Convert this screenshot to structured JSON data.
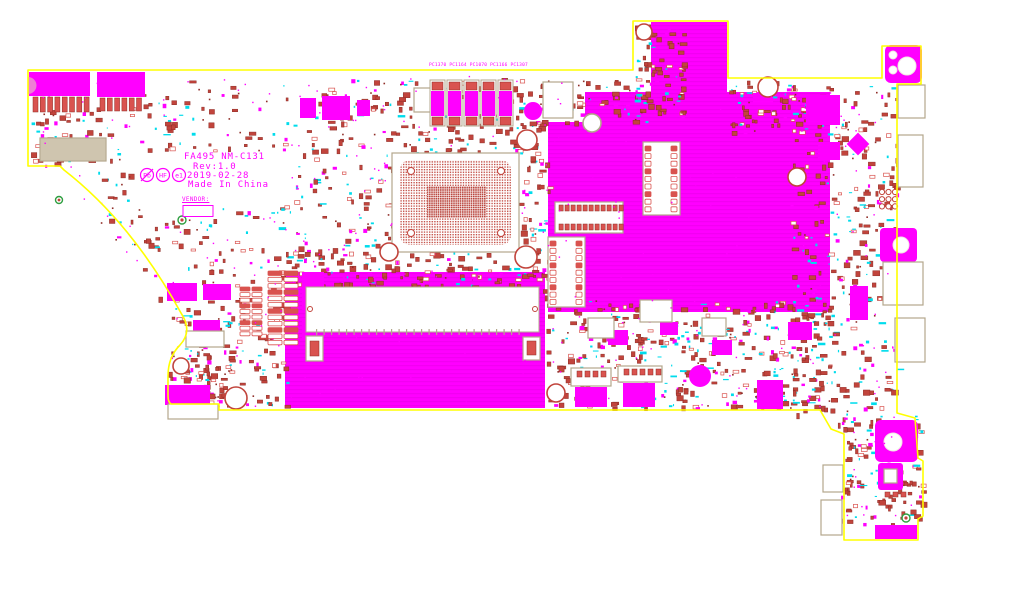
{
  "app": {
    "background": "#ffffff",
    "view": "boardview-top-layer"
  },
  "palette": {
    "bg": "#ffffff",
    "outline": "#ffff00",
    "copper": "#ff00ff",
    "copper_hatch": "#e200e2",
    "part": "#c1443c",
    "part_dark": "#8f2d27",
    "part_light": "#d97c74",
    "cyan": "#00dcec",
    "tan": "#cfc5af",
    "tan_dark": "#b3a78c",
    "silk_text": "#ff00ff",
    "pad_red": "#d9534f",
    "green": "#2e9e40",
    "notch_pink": "#ee7fd4"
  },
  "board": {
    "title_block": {
      "model": "FA495 NM-C131",
      "rev": "Rev:1.0",
      "date": "2019-02-28",
      "origin": "Made In China",
      "vendor_label": "VENDOR:"
    },
    "compliance_marks": [
      {
        "label": "Pb",
        "slash": true
      },
      {
        "label": "HF",
        "slash": false
      },
      {
        "label": "e1",
        "slash": false
      }
    ],
    "cap_labels": "PC1370 PC1164 PC1070 PC1166 PC1307",
    "outline_path": "M28,70 L633,70 L633,21 L728,21 L728,78 L882,78 L882,46 L921,46 L921,84 L897,84 L897,413 L915,418 L918,458 L923,461 L923,516 L918,519 L918,540 L844,540 L844,434 L831,429 L820,410 L219,410 L219,404 L171,404 Q168,402 168,396 L168,376 Q168,357 180,345 Q193,331 181,313 Q131,222 64,170 L60,166 L28,166 Z",
    "notch_path": "M28,77 A8.5,8.5 0 0 1 28,94 Z",
    "copper_regions": [
      "M548,122 L585,122 L585,92 L651,92 L651,22 L727,22 L727,92 L830,92 L830,312 L548,312 Z",
      "M285,272 L545,272 L545,408 L285,408 Z"
    ],
    "copper_blocks": [
      [
        29,
        72,
        61,
        24
      ],
      [
        97,
        72,
        48,
        25
      ],
      [
        300,
        98,
        16,
        20
      ],
      [
        322,
        96,
        28,
        24
      ],
      [
        357,
        100,
        13,
        16
      ],
      [
        549,
        87,
        17,
        26
      ],
      [
        753,
        93,
        20,
        12
      ],
      [
        167,
        283,
        30,
        18
      ],
      [
        203,
        284,
        28,
        16
      ],
      [
        302,
        272,
        22,
        38
      ],
      [
        302,
        318,
        16,
        22
      ],
      [
        193,
        320,
        27,
        15
      ],
      [
        165,
        385,
        45,
        20
      ],
      [
        192,
        334,
        26,
        11
      ],
      [
        575,
        387,
        32,
        20
      ],
      [
        623,
        383,
        32,
        24
      ],
      [
        757,
        380,
        26,
        29
      ],
      [
        608,
        330,
        20,
        15
      ],
      [
        660,
        322,
        18,
        13
      ],
      [
        712,
        340,
        20,
        15
      ],
      [
        788,
        322,
        24,
        18
      ],
      [
        806,
        95,
        34,
        30
      ],
      [
        818,
        142,
        22,
        18
      ],
      [
        850,
        286,
        18,
        34
      ],
      [
        880,
        228,
        37,
        34,
        4
      ],
      [
        885,
        45,
        37,
        38,
        6
      ],
      [
        875,
        420,
        43,
        42,
        6
      ],
      [
        878,
        463,
        25,
        27,
        3
      ],
      [
        875,
        525,
        42,
        14
      ]
    ],
    "diamonds": [
      [
        858,
        144,
        16
      ]
    ],
    "boxes": [
      [
        555,
        202,
        68,
        31
      ],
      [
        643,
        142,
        37,
        73
      ],
      [
        548,
        237,
        37,
        70
      ],
      [
        414,
        88,
        26,
        24
      ],
      [
        543,
        82,
        30,
        36
      ],
      [
        186,
        331,
        38,
        16
      ],
      [
        168,
        404,
        50,
        15
      ],
      [
        571,
        368,
        40,
        18
      ],
      [
        618,
        366,
        44,
        16
      ],
      [
        898,
        85,
        27,
        33
      ],
      [
        898,
        135,
        25,
        52
      ],
      [
        883,
        262,
        40,
        43
      ],
      [
        895,
        318,
        30,
        44
      ],
      [
        823,
        465,
        20,
        27
      ],
      [
        821,
        500,
        21,
        35
      ],
      [
        306,
        336,
        17,
        25
      ],
      [
        523,
        337,
        17,
        23
      ],
      [
        588,
        318,
        26,
        20
      ],
      [
        640,
        300,
        32,
        22
      ],
      [
        702,
        318,
        24,
        18
      ],
      [
        884,
        469,
        13,
        14
      ],
      [
        40,
        138,
        66,
        23
      ]
    ],
    "pad_rows": [
      [
        33,
        97,
        8,
        7.3,
        5,
        15
      ],
      [
        100,
        98,
        6,
        7.3,
        5,
        13
      ],
      [
        559,
        205,
        11,
        6,
        4.2,
        6
      ],
      [
        559,
        224,
        11,
        6,
        4.2,
        6
      ],
      [
        314,
        291,
        36,
        6,
        4.2,
        9
      ],
      [
        314,
        317,
        36,
        6,
        4.2,
        9
      ],
      [
        577,
        371,
        4,
        8,
        5,
        6
      ],
      [
        624,
        369,
        5,
        8,
        5,
        6
      ],
      [
        310,
        341,
        1,
        0,
        9,
        15
      ],
      [
        527,
        341,
        1,
        0,
        9,
        14
      ],
      [
        885,
        492,
        3,
        8,
        5,
        5
      ]
    ],
    "ladders": [
      [
        645,
        146,
        9,
        7.6,
        6,
        5
      ],
      [
        671,
        146,
        9,
        7.6,
        6,
        5
      ],
      [
        550,
        241,
        9,
        7.3,
        6,
        5
      ],
      [
        576,
        241,
        9,
        7.3,
        6,
        5
      ],
      [
        268,
        271,
        12,
        6.3,
        14,
        4.5
      ],
      [
        284,
        271,
        12,
        6.3,
        14,
        4.5
      ],
      [
        240,
        287,
        9,
        5.6,
        10,
        4
      ],
      [
        252,
        287,
        9,
        5.6,
        10,
        4
      ]
    ],
    "caps_row": {
      "x0": 430,
      "dx": 17,
      "n": 5,
      "y": 80
    },
    "bga": {
      "x": 392,
      "y": 153,
      "w": 127,
      "h": 99,
      "pad": 8,
      "dense": [
        427,
        186,
        59,
        32
      ],
      "corners": [
        [
          411,
          171
        ],
        [
          501,
          171
        ],
        [
          411,
          233
        ],
        [
          501,
          233
        ]
      ]
    },
    "ram": {
      "x": 306,
      "y": 287,
      "w": 233,
      "h": 45,
      "ticks": 28
    },
    "circles": [
      [
        644,
        32,
        8,
        "ring"
      ],
      [
        768,
        87,
        10,
        "ring"
      ],
      [
        592,
        123,
        9,
        "ringTan"
      ],
      [
        797,
        177,
        9,
        "ring"
      ],
      [
        527,
        140,
        10,
        "ring"
      ],
      [
        533,
        111,
        9,
        "fillM"
      ],
      [
        389,
        252,
        9,
        "ring"
      ],
      [
        526,
        257,
        11,
        "ring"
      ],
      [
        236,
        398,
        11,
        "ring"
      ],
      [
        556,
        393,
        9,
        "ring"
      ],
      [
        700,
        376,
        11,
        "fillM"
      ],
      [
        181,
        366,
        8,
        "ring"
      ],
      [
        59,
        200,
        3.5,
        "green"
      ],
      [
        182,
        220,
        4,
        "green"
      ],
      [
        906,
        518,
        4,
        "green"
      ],
      [
        901,
        245,
        8,
        "white"
      ],
      [
        907,
        66,
        9,
        "white"
      ],
      [
        893,
        55,
        4,
        "white"
      ],
      [
        893,
        70,
        4,
        "white"
      ],
      [
        893,
        442,
        9,
        "white"
      ],
      [
        310,
        309,
        2.5,
        "ringS"
      ],
      [
        535,
        309,
        2.5,
        "ringS"
      ]
    ],
    "ring_cluster": {
      "x": 882,
      "y": 192,
      "cols": 3,
      "rows": 3,
      "dx": 6.5,
      "dy": 7.2,
      "r": 2.6
    },
    "scatter_regions": [
      [
        95,
        78,
        300,
        225,
        420
      ],
      [
        30,
        110,
        62,
        55,
        45
      ],
      [
        165,
        300,
        122,
        108,
        150
      ],
      [
        285,
        252,
        262,
        36,
        110
      ],
      [
        395,
        75,
        152,
        88,
        130
      ],
      [
        515,
        90,
        33,
        222,
        90
      ],
      [
        545,
        300,
        290,
        108,
        430
      ],
      [
        790,
        85,
        108,
        330,
        310
      ],
      [
        635,
        20,
        48,
        96,
        90
      ],
      [
        728,
        80,
        78,
        52,
        70
      ],
      [
        838,
        415,
        84,
        112,
        130
      ],
      [
        160,
        345,
        70,
        60,
        55
      ],
      [
        540,
        80,
        110,
        42,
        60
      ]
    ],
    "exclusion_rects": [
      [
        392,
        153,
        127,
        99
      ],
      [
        135,
        150,
        150,
        55
      ],
      [
        306,
        287,
        233,
        45
      ],
      [
        183,
        197,
        34,
        22
      ]
    ],
    "via_count": 290,
    "leg_via_count": 20,
    "seed": 1234
  }
}
